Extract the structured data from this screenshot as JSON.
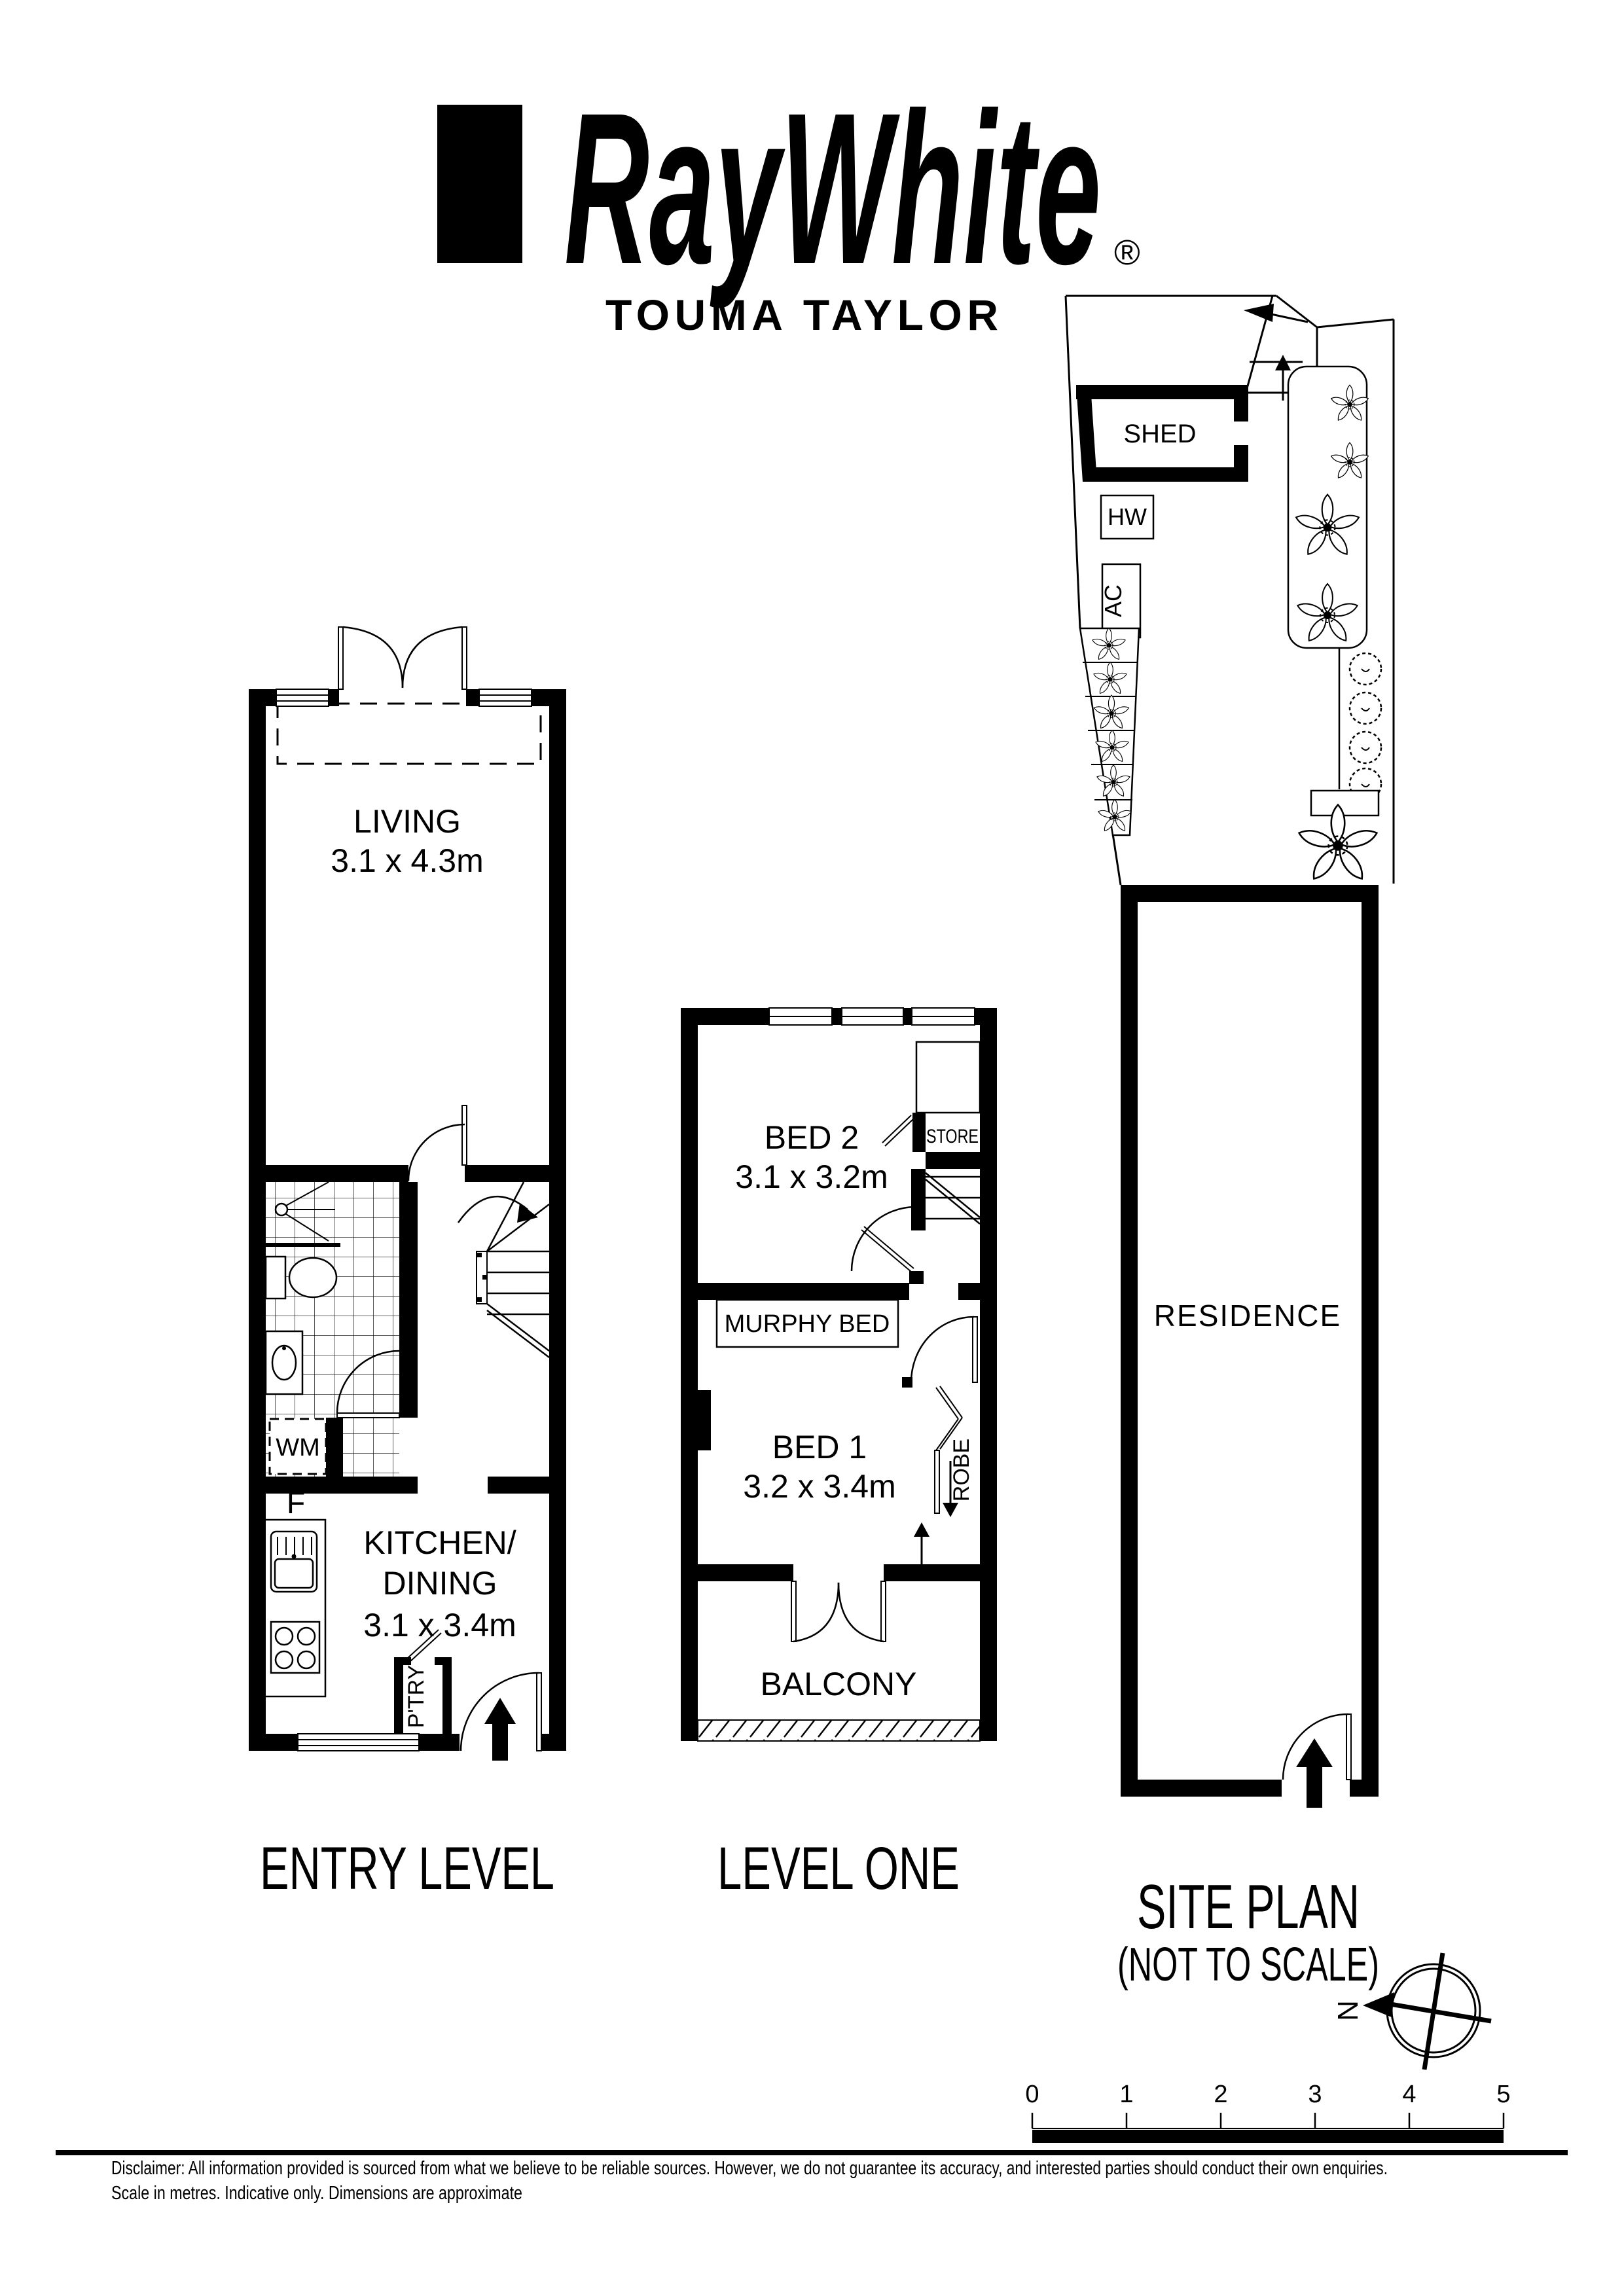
{
  "header": {
    "brand": "RayWhite",
    "registered": "®",
    "office": "TOUMA TAYLOR"
  },
  "floorplans": {
    "entry_level": {
      "label": "ENTRY LEVEL",
      "living_name": "LIVING",
      "living_dims": "3.1 x 4.3m",
      "kitchen_line1": "KITCHEN/",
      "kitchen_line2": "DINING",
      "kitchen_dims": "3.1 x 3.4m",
      "washing_machine": "WM",
      "fridge": "F",
      "pantry": "P'TRY"
    },
    "level_one": {
      "label": "LEVEL ONE",
      "bed2_name": "BED 2",
      "bed2_dims": "3.1 x 3.2m",
      "bed1_name": "BED 1",
      "bed1_dims": "3.2 x 3.4m",
      "store": "STORE",
      "murphy_bed": "MURPHY BED",
      "robe": "ROBE",
      "balcony": "BALCONY"
    },
    "site_plan": {
      "label": "SITE PLAN",
      "sublabel": "(NOT TO SCALE)",
      "shed": "SHED",
      "hot_water": "HW",
      "air_conditioner": "AC",
      "residence": "RESIDENCE"
    }
  },
  "compass": {
    "north": "N"
  },
  "scale_bar": {
    "ticks": [
      "0",
      "1",
      "2",
      "3",
      "4",
      "5"
    ]
  },
  "footer": {
    "disclaimer_line1": "Disclaimer: All information provided is sourced from what we believe to be reliable sources. However, we do not guarantee its accuracy, and interested parties should conduct their own enquiries.",
    "disclaimer_line2": "Scale in metres. Indicative only. Dimensions are approximate"
  },
  "colors": {
    "ink": "#000000",
    "paper": "#ffffff"
  }
}
